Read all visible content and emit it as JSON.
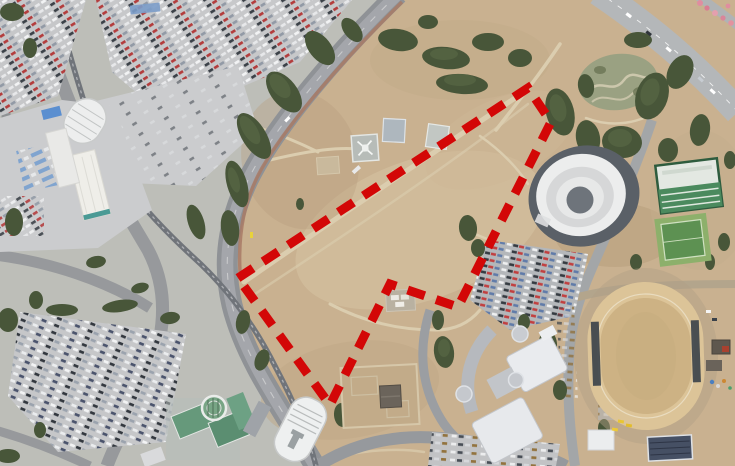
{
  "image": {
    "kind": "satellite-aerial-photograph",
    "description": "Aerial view of a large tan vacant parkland between an urban transit corridor, a white domed arena, an equestrian dirt track and commercial buildings; a red dashed boundary outlines a development site on the open field.",
    "width_px": 735,
    "height_px": 466
  },
  "overlay": {
    "name": "site-boundary",
    "shape": "closed-polygon",
    "color": "#d30707",
    "stroke_width": 9,
    "dash": "18 12",
    "points": "238,278 528,88 551,122 458,307 390,284 330,405",
    "vertices": [
      {
        "x": 238,
        "y": 278
      },
      {
        "x": 528,
        "y": 88
      },
      {
        "x": 551,
        "y": 122
      },
      {
        "x": 458,
        "y": 307
      },
      {
        "x": 390,
        "y": 284
      },
      {
        "x": 330,
        "y": 405
      }
    ]
  },
  "features": [
    {
      "name": "open-field",
      "desc": "large tan dirt/grass field"
    },
    {
      "name": "dome-arena",
      "desc": "white oval domed stadium"
    },
    {
      "name": "dirt-track",
      "desc": "sand equestrian oval track"
    },
    {
      "name": "maze-garden",
      "desc": "serpentine hedge garden"
    },
    {
      "name": "helipads",
      "desc": "three square helicopter pads, one with helicopter"
    },
    {
      "name": "monorail-station-north",
      "desc": "white oval station roof"
    },
    {
      "name": "monorail-station-south",
      "desc": "white ribbed station roof"
    },
    {
      "name": "sports-courts",
      "desc": "green court and striped-roof hall"
    },
    {
      "name": "mall-buildings",
      "desc": "white curved commercial roofs"
    },
    {
      "name": "parking-lots",
      "desc": "dense car parking areas"
    },
    {
      "name": "highway",
      "desc": "curved expressway top right"
    },
    {
      "name": "blossom-trees",
      "desc": "pink flowering trees at top right corner"
    }
  ],
  "palette": {
    "field_tan": "#c9b190",
    "field_light": "#d5c3a3",
    "field_dark": "#b79e7d",
    "urban_gray": "#c0c1c3",
    "road_gray": "#94979a",
    "highway_gray": "#b4b7b9",
    "tree_green": "#485639",
    "tree_light": "#5d6d49",
    "dome_white": "#eceded",
    "apron_dark": "#5a6067",
    "track_sand": "#dcc498",
    "court_green": "#5d9152",
    "boundary_red": "#d30707"
  }
}
